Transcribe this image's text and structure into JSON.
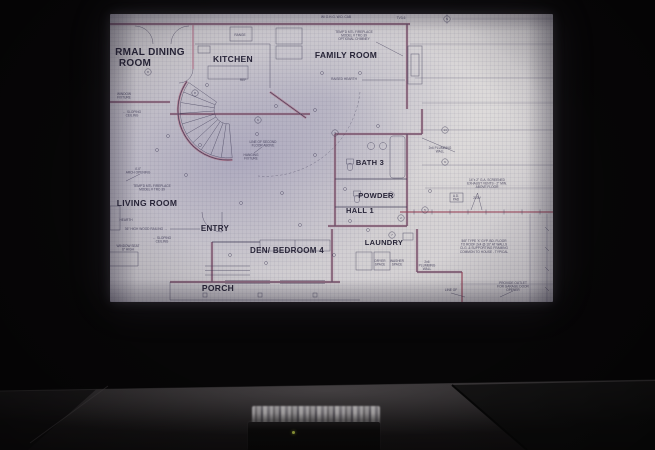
{
  "scene_description": "Photograph of a dark room: an architectural floor-plan blueprint is projected on a screen above a dark table; a small black media box with a green LED sits on the table reflecting the screen",
  "colors": {
    "bg": "#070607",
    "paper": "#cbc8ce",
    "paper-warm": "#d7d4d4",
    "tint-blue": "#8f8cb0",
    "ink": "#3b3752",
    "ink-dark": "#282538",
    "wall-pink": "#b0758a",
    "accent-red": "#99485c",
    "table": "#262324",
    "led": "#98a33c"
  },
  "blueprint": {
    "rooms": [
      {
        "label": "RMAL DINING",
        "x": 40,
        "y": 41,
        "fs": 10
      },
      {
        "label": "ROOM",
        "x": 25,
        "y": 52,
        "fs": 10
      },
      {
        "label": "KITCHEN",
        "x": 123,
        "y": 48,
        "fs": 8.5
      },
      {
        "label": "FAMILY ROOM",
        "x": 236,
        "y": 44,
        "fs": 8.5
      },
      {
        "label": "LIVING ROOM",
        "x": 37,
        "y": 192,
        "fs": 8.5
      },
      {
        "label": "ENTRY",
        "x": 105,
        "y": 217,
        "fs": 8
      },
      {
        "label": "DEN/ BEDROOM 4",
        "x": 177,
        "y": 239,
        "fs": 8
      },
      {
        "label": "PORCH",
        "x": 108,
        "y": 277,
        "fs": 8.5
      },
      {
        "label": "BATH 3",
        "x": 260,
        "y": 151,
        "fs": 7.5
      },
      {
        "label": "POWDER",
        "x": 266,
        "y": 184,
        "fs": 7.5
      },
      {
        "label": "HALL 1",
        "x": 250,
        "y": 199,
        "fs": 7.5
      },
      {
        "label": "LAUNDRY",
        "x": 274,
        "y": 231,
        "fs": 7.5
      }
    ],
    "notes": [
      {
        "lines": [
          "W/ O.H.G. W.D. CAB"
        ],
        "x": 226,
        "y": 4
      },
      {
        "lines": [
          "TV3-6"
        ],
        "x": 291,
        "y": 5
      },
      {
        "lines": [
          "TEMP'D MTL FIREPLACE",
          "MODEL # TRC-39",
          "OPTIONAL CHIMNEY"
        ],
        "x": 244,
        "y": 19
      },
      {
        "lines": [
          "RAISED HEARTH"
        ],
        "x": 234,
        "y": 66
      },
      {
        "lines": [
          "RANGE"
        ],
        "x": 130,
        "y": 22
      },
      {
        "lines": [
          "REF"
        ],
        "x": 133,
        "y": 67
      },
      {
        "lines": [
          "WINDOW",
          "FIXTURE"
        ],
        "x": 14,
        "y": 81
      },
      {
        "lines": [
          "← SLOPING",
          "CEILING"
        ],
        "x": 22,
        "y": 99
      },
      {
        "lines": [
          "4'-0\"",
          "ARCH OPENING"
        ],
        "x": 28,
        "y": 156
      },
      {
        "lines": [
          "TEMP'D MTL FIREPLACE",
          "MODEL # TRC-39"
        ],
        "x": 42,
        "y": 173
      },
      {
        "lines": [
          "HEARTH"
        ],
        "x": 16,
        "y": 207
      },
      {
        "lines": [
          "36\" HIGH WOOD RAILING →"
        ],
        "x": 36,
        "y": 216
      },
      {
        "lines": [
          "← SLOPING",
          "CEILING"
        ],
        "x": 52,
        "y": 225
      },
      {
        "lines": [
          "WINDOW SEAT",
          "6\" HIGH"
        ],
        "x": 18,
        "y": 233
      },
      {
        "lines": [
          "LINE OF SECOND",
          "FLOOR ABOVE"
        ],
        "x": 153,
        "y": 129
      },
      {
        "lines": [
          "HANGING",
          "FIXTURE"
        ],
        "x": 141,
        "y": 142
      },
      {
        "lines": [
          "2x6 PLUMBING",
          "WALL"
        ],
        "x": 330,
        "y": 135
      },
      {
        "lines": [
          "14\"x 2\" G.A. SCREENED",
          "EXHAUST VENTS - 2\" MIN.",
          "ABOVE FLOOR"
        ],
        "x": 377,
        "y": 167
      },
      {
        "lines": [
          "A.D.",
          "PAD"
        ],
        "x": 346,
        "y": 183
      },
      {
        "lines": [
          "220V"
        ],
        "x": 367,
        "y": 185
      },
      {
        "lines": [
          "5/8\" TYPE 'X' GYP. BD. FLOOR",
          "TO ROOF 2x4 @ 16\" AT WALLS",
          "CLG. & SUPPORTING FRAMING",
          "COMMON TO HOUSE - TYPICAL"
        ],
        "x": 374,
        "y": 228
      },
      {
        "lines": [
          "2x6",
          "PLUMBING",
          "WALL"
        ],
        "x": 317,
        "y": 249
      },
      {
        "lines": [
          "DRYER",
          "SPACE"
        ],
        "x": 270,
        "y": 248
      },
      {
        "lines": [
          "WASHER",
          "SPACE"
        ],
        "x": 287,
        "y": 248
      },
      {
        "lines": [
          "PROVIDE OUTLET",
          "FOR GARAGE DOOR",
          "OPENER"
        ],
        "x": 403,
        "y": 270
      },
      {
        "lines": [
          "LINE OF"
        ],
        "x": 341,
        "y": 277
      }
    ],
    "bubbles": [
      {
        "n": "8",
        "x": 38,
        "y": 58
      },
      {
        "n": "8",
        "x": 85,
        "y": 79
      },
      {
        "n": "6",
        "x": 148,
        "y": 106
      },
      {
        "n": "3",
        "x": 225,
        "y": 119
      },
      {
        "n": "9",
        "x": 335,
        "y": 148
      },
      {
        "n": "5",
        "x": 315,
        "y": 196
      },
      {
        "n": "2",
        "x": 291,
        "y": 204
      },
      {
        "n": "7",
        "x": 282,
        "y": 221
      },
      {
        "n": "N",
        "x": 337,
        "y": 5
      },
      {
        "n": "14",
        "x": 335,
        "y": 116
      }
    ]
  }
}
